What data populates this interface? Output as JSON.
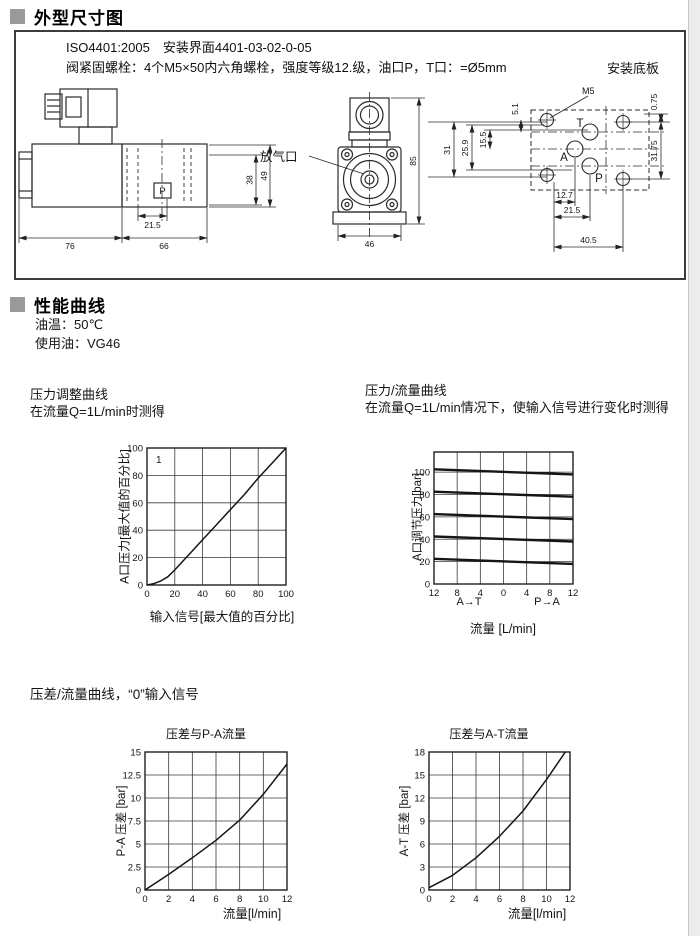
{
  "page": {
    "bg": "#ffffff",
    "accent_gray": "#9a9a9a",
    "line_color": "#2b2b2b"
  },
  "sections": {
    "dimensions": {
      "title": "外型尺寸图",
      "spec_line1": "ISO4401:2005　安装界面4401-03-02-0-05",
      "spec_line2": "阀紧固螺栓：4个M5×50内六角螺栓，强度等级12.级，油口P，T口：=Ø5mm",
      "subplate_label": "安装底板",
      "side_view": {
        "dim_width_left": "76",
        "dim_width_right": "66",
        "dim_port_offset": "21.5",
        "dim_height_inner": "38",
        "dim_height_outer": "49",
        "port_label": "P"
      },
      "front_view": {
        "dim_width": "46",
        "dim_height": "85",
        "bleed_port_label": "放气口"
      },
      "plate_view": {
        "thread_label": "M5",
        "port_t": "T",
        "port_a": "A",
        "port_p": "P",
        "dim_5_1": "5.1",
        "dim_15_5": "15.5",
        "dim_25_9": "25.9",
        "dim_31": "31",
        "dim_0_75": "0.75",
        "dim_31_75": "31.75",
        "dim_12_7": "12.7",
        "dim_21_5": "21.5",
        "dim_40_5": "40.5"
      }
    },
    "performance": {
      "title": "性能曲线",
      "oil_temp": "油温：50℃",
      "oil_used": "使用油：VG46",
      "dp_section_header": "压差/流量曲线，“0”输入信号"
    }
  },
  "chart_data": [
    {
      "id": "pressure-adjustment-curve",
      "type": "line",
      "title": "压力调整曲线",
      "subtitle": "在流量Q=1L/min时测得",
      "corner_label": "1",
      "xlabel": "输入信号[最大值的百分比]",
      "ylabel": "A口压力[最大值的百分比]",
      "xlim": [
        0,
        100
      ],
      "ylim": [
        0,
        100
      ],
      "xticks": [
        0,
        20,
        40,
        60,
        80,
        100
      ],
      "yticks": [
        0,
        20,
        40,
        60,
        80,
        100
      ],
      "grid": true,
      "legend_position": "none",
      "series": [
        {
          "name": "A口压力",
          "points": [
            [
              0,
              0
            ],
            [
              5,
              1
            ],
            [
              10,
              3
            ],
            [
              15,
              6
            ],
            [
              20,
              11
            ],
            [
              30,
              22
            ],
            [
              40,
              33
            ],
            [
              50,
              44
            ],
            [
              60,
              55
            ],
            [
              70,
              66
            ],
            [
              80,
              78
            ],
            [
              90,
              89
            ],
            [
              100,
              100
            ]
          ]
        }
      ]
    },
    {
      "id": "pressure-flow-curve",
      "type": "line",
      "title": "压力/流量曲线",
      "subtitle": "在流量Q=1L/min情况下，使输入信号进行变化时测得",
      "xlabel": "流量 [L/min]",
      "ylabel": "A口调节压力[bar]",
      "direction_label_left": "A→T",
      "direction_label_right": "P→A",
      "xlim": [
        -12,
        12
      ],
      "ylim": [
        0,
        118
      ],
      "xticks": [
        -12,
        -8,
        -4,
        0,
        4,
        8,
        12
      ],
      "xtick_labels": [
        "12",
        "8",
        "4",
        "0",
        "4",
        "8",
        "12"
      ],
      "yticks": [
        0,
        20,
        40,
        60,
        80,
        100
      ],
      "grid": true,
      "legend_position": "none",
      "series": [
        {
          "name": "调节压力100bar",
          "points": [
            [
              -12,
              102.5
            ],
            [
              12,
              98
            ]
          ]
        },
        {
          "name": "调节压力80bar",
          "points": [
            [
              -12,
              82.5
            ],
            [
              12,
              78
            ]
          ]
        },
        {
          "name": "调节压力60bar",
          "points": [
            [
              -12,
              62.5
            ],
            [
              12,
              58
            ]
          ]
        },
        {
          "name": "调节压力40bar",
          "points": [
            [
              -12,
              42.5
            ],
            [
              12,
              38
            ]
          ]
        },
        {
          "name": "调节压力20bar",
          "points": [
            [
              -12,
              22.5
            ],
            [
              12,
              18
            ]
          ]
        }
      ]
    },
    {
      "id": "dp-vs-pa-flow",
      "type": "line",
      "title": "压差与P-A流量",
      "xlabel": "流量[l/min]",
      "ylabel": "P-A 压差 [bar]",
      "xlim": [
        0,
        12
      ],
      "ylim": [
        0,
        15
      ],
      "xticks": [
        0,
        2,
        4,
        6,
        8,
        10,
        12
      ],
      "yticks": [
        0,
        2.5,
        5,
        7.5,
        10,
        12.5,
        15
      ],
      "ytick_labels": [
        "0",
        "2.5",
        "5",
        "7.5",
        "10",
        "12.5",
        "15"
      ],
      "grid": true,
      "legend_position": "none",
      "series": [
        {
          "name": "P-A压差",
          "points": [
            [
              0,
              0
            ],
            [
              2,
              1.7
            ],
            [
              4,
              3.5
            ],
            [
              6,
              5.4
            ],
            [
              8,
              7.6
            ],
            [
              10,
              10.4
            ],
            [
              12,
              13.7
            ]
          ]
        }
      ]
    },
    {
      "id": "dp-vs-at-flow",
      "type": "line",
      "title": "压差与A-T流量",
      "xlabel": "流量[l/min]",
      "ylabel": "A-T 压差 [bar]",
      "xlim": [
        0,
        12
      ],
      "ylim": [
        0,
        18
      ],
      "xticks": [
        0,
        2,
        4,
        6,
        8,
        10,
        12
      ],
      "yticks": [
        0,
        3,
        6,
        9,
        12,
        15,
        18
      ],
      "grid": true,
      "legend_position": "none",
      "series": [
        {
          "name": "A-T压差",
          "points": [
            [
              0,
              0.3
            ],
            [
              2,
              1.9
            ],
            [
              4,
              4.2
            ],
            [
              6,
              7
            ],
            [
              8,
              10.3
            ],
            [
              10,
              14.4
            ],
            [
              11.6,
              18
            ]
          ]
        }
      ]
    }
  ]
}
